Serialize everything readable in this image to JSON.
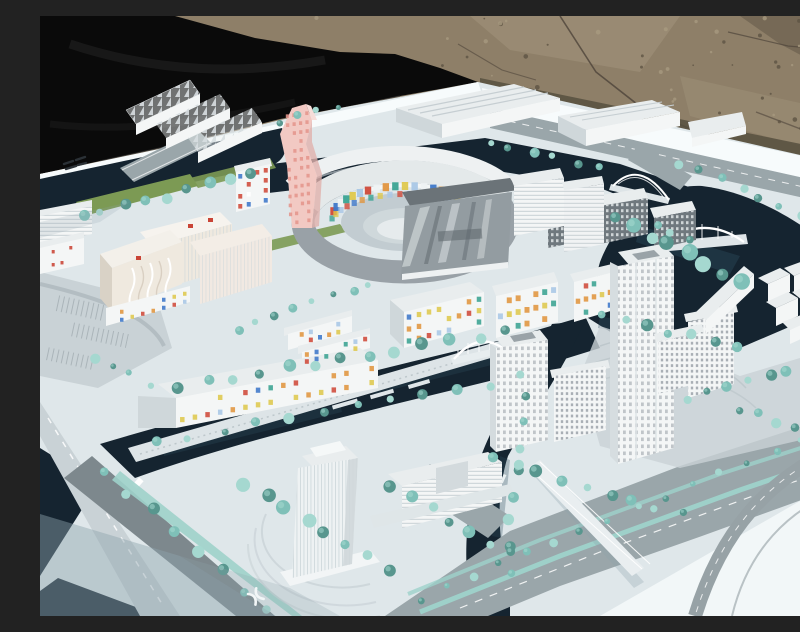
{
  "scene": {
    "alt": "Outdoor photograph of a white architectural scale model of a waterfront city district. The model sits on a white baseboard placed on brown gravel ground; a black tarp covers the upper-left corner. The model features dark navy canals and a lake, teal model trees, gray boulevards, white mid-rise and high-rise buildings, a pink twisted tower with dotted facade, an oval courtyard building with multicolored mosaic walls, twin office towers, arch bridges, and buildings speckled with small red, blue, orange and yellow windows.",
    "subject": "urban-planning-scale-model",
    "setting": "outdoors-on-gravel-ground",
    "text_content": "none-legible"
  },
  "palette": {
    "dirt": "#8e7f68",
    "dirtLight": "#a79a80",
    "dirtDark": "#5e5443",
    "crack": "#4e443a",
    "tarp": "#0a0a0a",
    "tarpFold": "#1f1f1f",
    "board": "#dfe7ea",
    "boardBright": "#f7fbfc",
    "boardShade": "#8fa3ad",
    "water": "#152430",
    "waterLight": "#2e4d5e",
    "tree": "#7fc0b8",
    "treeLight": "#a5d8d0",
    "treeDark": "#58968e",
    "lawn": "#7c9a54",
    "road": "#9aa6aa",
    "roadDark": "#7d888d",
    "roadLight": "#c9d2d6",
    "median": "#9ed2ca",
    "bldg": "#f4f6f6",
    "bldgShade": "#cfd7da",
    "bldgRoof": "#e9edee",
    "slabDark": "#6f787e",
    "metal": "#939ca1",
    "metalDark": "#6b7378",
    "cream": "#efe9df",
    "creamShade": "#d9d2c6",
    "pink": "#f2c9c3",
    "pinkDot": "#e4958c",
    "redMark": "#c94436",
    "glyph": "#2b3136",
    "white": "#ffffff"
  },
  "mosaic_colors": [
    "#cf4a3a",
    "#3e78c9",
    "#e0953f",
    "#3aa392",
    "#dec84d",
    "#a9c7e6"
  ]
}
